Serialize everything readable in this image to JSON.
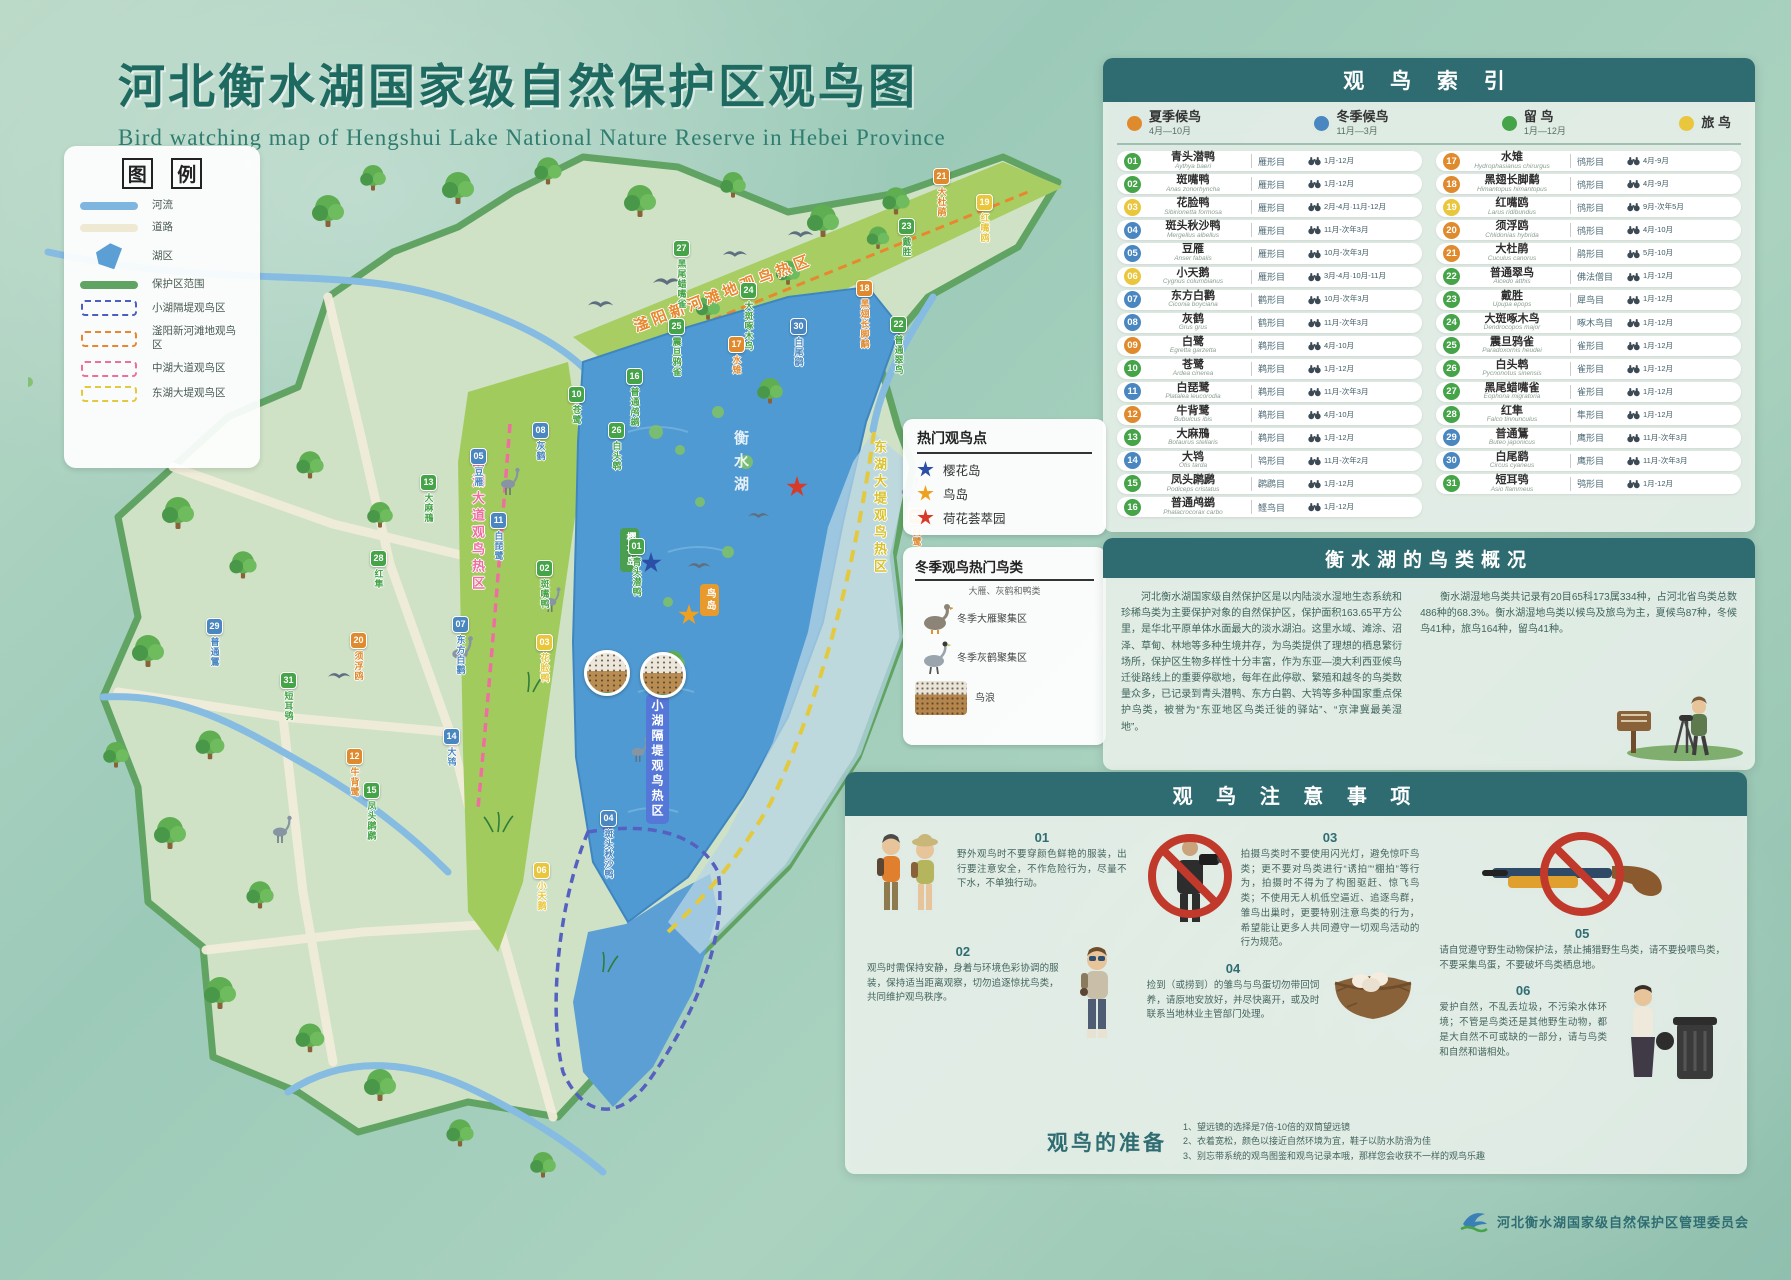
{
  "page": {
    "title": "河北衡水湖国家级自然保护区观鸟图",
    "subtitle": "Bird watching map of Hengshui Lake National Nature Reserve in Hebei Province"
  },
  "legend": {
    "title_left": "图",
    "title_right": "例",
    "items": [
      {
        "label": "河流",
        "type": "line",
        "color": "#7fb6df"
      },
      {
        "label": "道路",
        "type": "line",
        "color": "#efe8d2"
      },
      {
        "label": "湖区",
        "type": "poly",
        "color": "#5b9fd4"
      },
      {
        "label": "保护区范围",
        "type": "line",
        "color": "#61a363"
      },
      {
        "label": "小湖隔堤观鸟区",
        "type": "dash",
        "color": "#4a5fc0"
      },
      {
        "label": "滏阳新河滩地观鸟区",
        "type": "dash",
        "color": "#e8872e"
      },
      {
        "label": "中湖大道观鸟区",
        "type": "dash",
        "color": "#ee6f9f"
      },
      {
        "label": "东湖大堤观鸟区",
        "type": "dash",
        "color": "#e3c93d"
      }
    ]
  },
  "map": {
    "corridors": {
      "fuyang": "滏阳新河滩地观鸟热区",
      "zhonghu": "中湖大道观鸟热区",
      "donghu": "东湖大堤观鸟热区",
      "xiaohu": "小湖隔堤观鸟热区"
    },
    "lake_label": "衡水湖",
    "island_labels": [
      {
        "label": "樱花岛",
        "color": "#4a9e4f",
        "left": "592px",
        "top": "396px"
      },
      {
        "label": "鸟岛",
        "color": "#e99a2c",
        "left": "672px",
        "top": "452px"
      }
    ],
    "stars": [
      {
        "color": "#2b4fa7",
        "left": "612px",
        "top": "420px"
      },
      {
        "color": "#f0a01f",
        "left": "650px",
        "top": "472px"
      },
      {
        "color": "#d83a2a",
        "left": "758px",
        "top": "344px"
      }
    ],
    "photos": [
      {
        "label": "大雁",
        "left": "556px",
        "top": "518px"
      },
      {
        "label": "灰鹤",
        "left": "612px",
        "top": "520px"
      }
    ],
    "markers": [
      {
        "num": "21",
        "name": "大杜鹃",
        "color": "#e08a2e",
        "left": "905px",
        "top": "36px"
      },
      {
        "num": "19",
        "name": "红嘴鸥",
        "color": "#e9c63b",
        "left": "948px",
        "top": "62px"
      },
      {
        "num": "23",
        "name": "戴胜",
        "color": "#45a348",
        "left": "870px",
        "top": "86px"
      },
      {
        "num": "27",
        "name": "黑尾蜡嘴雀",
        "color": "#45a348",
        "left": "645px",
        "top": "108px"
      },
      {
        "num": "24",
        "name": "大斑啄木鸟",
        "color": "#45a348",
        "left": "712px",
        "top": "150px"
      },
      {
        "num": "18",
        "name": "黑翅长脚鹬",
        "color": "#e08a2e",
        "left": "828px",
        "top": "148px"
      },
      {
        "num": "22",
        "name": "普通翠鸟",
        "color": "#45a348",
        "left": "862px",
        "top": "184px"
      },
      {
        "num": "30",
        "name": "白尾鹞",
        "color": "#4a87c0",
        "left": "762px",
        "top": "186px"
      },
      {
        "num": "17",
        "name": "水雉",
        "color": "#e08a2e",
        "left": "700px",
        "top": "204px"
      },
      {
        "num": "25",
        "name": "震旦鸦雀",
        "color": "#45a348",
        "left": "640px",
        "top": "186px"
      },
      {
        "num": "16",
        "name": "普通鸬鹚",
        "color": "#45a348",
        "left": "598px",
        "top": "236px"
      },
      {
        "num": "10",
        "name": "苍鹭",
        "color": "#45a348",
        "left": "540px",
        "top": "254px"
      },
      {
        "num": "08",
        "name": "灰鹤",
        "color": "#4a87c0",
        "left": "504px",
        "top": "290px"
      },
      {
        "num": "05",
        "name": "豆雁",
        "color": "#4a87c0",
        "left": "442px",
        "top": "316px"
      },
      {
        "num": "13",
        "name": "大麻鳽",
        "color": "#45a348",
        "left": "392px",
        "top": "342px"
      },
      {
        "num": "26",
        "name": "白头鹎",
        "color": "#45a348",
        "left": "580px",
        "top": "290px"
      },
      {
        "num": "11",
        "name": "白琵鹭",
        "color": "#4a87c0",
        "left": "462px",
        "top": "380px"
      },
      {
        "num": "28",
        "name": "红隼",
        "color": "#45a348",
        "left": "342px",
        "top": "418px"
      },
      {
        "num": "02",
        "name": "斑嘴鸭",
        "color": "#45a348",
        "left": "508px",
        "top": "428px"
      },
      {
        "num": "01",
        "name": "青头潜鸭",
        "color": "#45a348",
        "left": "600px",
        "top": "406px"
      },
      {
        "num": "07",
        "name": "东方白鹳",
        "color": "#4a87c0",
        "left": "424px",
        "top": "484px"
      },
      {
        "num": "03",
        "name": "花脸鸭",
        "color": "#e9c63b",
        "left": "508px",
        "top": "502px"
      },
      {
        "num": "29",
        "name": "普通鵟",
        "color": "#4a87c0",
        "left": "178px",
        "top": "486px"
      },
      {
        "num": "31",
        "name": "短耳鸮",
        "color": "#45a348",
        "left": "252px",
        "top": "540px"
      },
      {
        "num": "20",
        "name": "须浮鸥",
        "color": "#e08a2e",
        "left": "322px",
        "top": "500px"
      },
      {
        "num": "14",
        "name": "大鸨",
        "color": "#4a87c0",
        "left": "415px",
        "top": "596px"
      },
      {
        "num": "12",
        "name": "牛背鹭",
        "color": "#e08a2e",
        "left": "318px",
        "top": "616px"
      },
      {
        "num": "15",
        "name": "凤头䴙䴘",
        "color": "#45a348",
        "left": "335px",
        "top": "650px"
      },
      {
        "num": "09",
        "name": "白鹭",
        "color": "#e08a2e",
        "left": "880px",
        "top": "376px"
      },
      {
        "num": "04",
        "name": "斑头秋沙鸭",
        "color": "#4a87c0",
        "left": "572px",
        "top": "678px"
      },
      {
        "num": "06",
        "name": "小天鹅",
        "color": "#e9c63b",
        "left": "505px",
        "top": "730px"
      }
    ]
  },
  "index": {
    "title": "观 鸟 索 引",
    "categories": [
      {
        "label": "夏季候鸟",
        "range": "4月—10月",
        "color": "#e08a2e"
      },
      {
        "label": "冬季候鸟",
        "range": "11月—3月",
        "color": "#4a87c0"
      },
      {
        "label": "留  鸟",
        "range": "1月—12月",
        "color": "#45a348"
      },
      {
        "label": "旅  鸟",
        "range": "",
        "color": "#e9c63b"
      }
    ],
    "birds": [
      {
        "num": "01",
        "name": "青头潜鸭",
        "latin": "Aythya baeri",
        "order": "雁形目",
        "months": "1月-12月",
        "color": "#45a348"
      },
      {
        "num": "02",
        "name": "斑嘴鸭",
        "latin": "Anas zonorhyncha",
        "order": "雁形目",
        "months": "1月-12月",
        "color": "#45a348"
      },
      {
        "num": "03",
        "name": "花脸鸭",
        "latin": "Sibirionetta formosa",
        "order": "雁形目",
        "months": "2月-4月·11月-12月",
        "color": "#e9c63b"
      },
      {
        "num": "04",
        "name": "斑头秋沙鸭",
        "latin": "Mergellus albellus",
        "order": "雁形目",
        "months": "11月-次年3月",
        "color": "#4a87c0"
      },
      {
        "num": "05",
        "name": "豆雁",
        "latin": "Anser fabalis",
        "order": "雁形目",
        "months": "10月-次年3月",
        "color": "#4a87c0"
      },
      {
        "num": "06",
        "name": "小天鹅",
        "latin": "Cygnus columbianus",
        "order": "雁形目",
        "months": "3月-4月·10月-11月",
        "color": "#e9c63b"
      },
      {
        "num": "07",
        "name": "东方白鹳",
        "latin": "Ciconia boyciana",
        "order": "鹳形目",
        "months": "10月-次年3月",
        "color": "#4a87c0"
      },
      {
        "num": "08",
        "name": "灰鹤",
        "latin": "Grus grus",
        "order": "鹤形目",
        "months": "11月-次年3月",
        "color": "#4a87c0"
      },
      {
        "num": "09",
        "name": "白鹭",
        "latin": "Egretta garzetta",
        "order": "鹈形目",
        "months": "4月-10月",
        "color": "#e08a2e"
      },
      {
        "num": "10",
        "name": "苍鹭",
        "latin": "Ardea cinerea",
        "order": "鹈形目",
        "months": "1月-12月",
        "color": "#45a348"
      },
      {
        "num": "11",
        "name": "白琵鹭",
        "latin": "Platalea leucorodia",
        "order": "鹈形目",
        "months": "11月-次年3月",
        "color": "#4a87c0"
      },
      {
        "num": "12",
        "name": "牛背鹭",
        "latin": "Bubulcus ibis",
        "order": "鹈形目",
        "months": "4月-10月",
        "color": "#e08a2e"
      },
      {
        "num": "13",
        "name": "大麻鳽",
        "latin": "Botaurus stellaris",
        "order": "鹈形目",
        "months": "1月-12月",
        "color": "#45a348"
      },
      {
        "num": "14",
        "name": "大鸨",
        "latin": "Otis tarda",
        "order": "鸨形目",
        "months": "11月-次年2月",
        "color": "#4a87c0"
      },
      {
        "num": "15",
        "name": "凤头䴙䴘",
        "latin": "Podiceps cristatus",
        "order": "䴙䴘目",
        "months": "1月-12月",
        "color": "#45a348"
      },
      {
        "num": "16",
        "name": "普通鸬鹚",
        "latin": "Phalacrocorax carbo",
        "order": "鲣鸟目",
        "months": "1月-12月",
        "color": "#45a348"
      },
      {
        "num": "17",
        "name": "水雉",
        "latin": "Hydrophasianus chirurgus",
        "order": "鸻形目",
        "months": "4月-9月",
        "color": "#e08a2e"
      },
      {
        "num": "18",
        "name": "黑翅长脚鹬",
        "latin": "Himantopus himantopus",
        "order": "鸻形目",
        "months": "4月-9月",
        "color": "#e08a2e"
      },
      {
        "num": "19",
        "name": "红嘴鸥",
        "latin": "Larus ridibundus",
        "order": "鸻形目",
        "months": "9月-次年5月",
        "color": "#e9c63b"
      },
      {
        "num": "20",
        "name": "须浮鸥",
        "latin": "Chlidonias hybrida",
        "order": "鸻形目",
        "months": "4月-10月",
        "color": "#e08a2e"
      },
      {
        "num": "21",
        "name": "大杜鹃",
        "latin": "Cuculus canorus",
        "order": "鹃形目",
        "months": "5月-10月",
        "color": "#e08a2e"
      },
      {
        "num": "22",
        "name": "普通翠鸟",
        "latin": "Alcedo atthis",
        "order": "佛法僧目",
        "months": "1月-12月",
        "color": "#45a348"
      },
      {
        "num": "23",
        "name": "戴胜",
        "latin": "Upupa epops",
        "order": "犀鸟目",
        "months": "1月-12月",
        "color": "#45a348"
      },
      {
        "num": "24",
        "name": "大斑啄木鸟",
        "latin": "Dendrocopos major",
        "order": "啄木鸟目",
        "months": "1月-12月",
        "color": "#45a348"
      },
      {
        "num": "25",
        "name": "震旦鸦雀",
        "latin": "Paradoxornis heudei",
        "order": "雀形目",
        "months": "1月-12月",
        "color": "#45a348"
      },
      {
        "num": "26",
        "name": "白头鹎",
        "latin": "Pycnonotus sinensis",
        "order": "雀形目",
        "months": "1月-12月",
        "color": "#45a348"
      },
      {
        "num": "27",
        "name": "黑尾蜡嘴雀",
        "latin": "Eophona migratoria",
        "order": "雀形目",
        "months": "1月-12月",
        "color": "#45a348"
      },
      {
        "num": "28",
        "name": "红隼",
        "latin": "Falco tinnunculus",
        "order": "隼形目",
        "months": "1月-12月",
        "color": "#45a348"
      },
      {
        "num": "29",
        "name": "普通鵟",
        "latin": "Buteo japonicus",
        "order": "鹰形目",
        "months": "11月-次年3月",
        "color": "#4a87c0"
      },
      {
        "num": "30",
        "name": "白尾鹞",
        "latin": "Circus cyaneus",
        "order": "鹰形目",
        "months": "11月-次年3月",
        "color": "#4a87c0"
      },
      {
        "num": "31",
        "name": "短耳鸮",
        "latin": "Asio flammeus",
        "order": "鸮形目",
        "months": "1月-12月",
        "color": "#45a348"
      }
    ]
  },
  "hotspots": {
    "title": "热门观鸟点",
    "items": [
      {
        "label": "樱花岛",
        "color": "#2b4fa7"
      },
      {
        "label": "鸟岛",
        "color": "#f0a01f"
      },
      {
        "label": "荷花荟萃园",
        "color": "#d83a2a"
      }
    ]
  },
  "winter": {
    "title": "冬季观鸟热门鸟类",
    "subtitle": "大雁、灰鹤和鸭类",
    "items": [
      {
        "label": "冬季大雁聚集区",
        "icon": "goose",
        "swatch": "#d0433b"
      },
      {
        "label": "冬季灰鹤聚集区",
        "icon": "crane",
        "swatch": "#e8c63a"
      },
      {
        "label": "鸟浪",
        "icon": "photo"
      }
    ]
  },
  "overview": {
    "title": "衡水湖的鸟类概况",
    "p1": "河北衡水湖国家级自然保护区是以内陆淡水湿地生态系统和珍稀鸟类为主要保护对象的自然保护区，保护面积163.65平方公里，是华北平原单体水面最大的淡水湖泊。这里水域、滩涂、沼泽、草甸、林地等多种生境并存，为鸟类提供了理想的栖息繁衍场所，保护区生物多样性十分丰富，作为东亚—澳大利西亚候鸟迁徙路线上的重要停歇地，每年在此停歇、繁殖和越冬的鸟类数量众多，已记录到青头潜鸭、东方白鹳、大鸨等多种国家重点保护鸟类，被誉为“东亚地区鸟类迁徙的驿站”、“京津冀最美湿地”。",
    "p2": "衡水湖湿地鸟类共记录有20目65科173属334种，占河北省鸟类总数486种的68.3%。衡水湖湿地鸟类以候鸟及旅鸟为主，夏候鸟87种，冬候鸟41种，旅鸟164种，留鸟41种。"
  },
  "notes": {
    "title": "观 鸟 注 意 事 项",
    "items": [
      {
        "num": "01",
        "text": "野外观鸟时不要穿颜色鲜艳的服装，出行要注意安全，不作危险行为，尽量不下水，不单独行动。"
      },
      {
        "num": "02",
        "text": "观鸟时需保持安静，身着与环境色彩协调的服装，保持适当距离观察，切勿追逐惊扰鸟类，共同维护观鸟秩序。"
      },
      {
        "num": "03",
        "text": "拍摄鸟类时不要使用闪光灯，避免惊吓鸟类；更不要对鸟类进行“诱拍”“棚拍”等行为，拍摄时不得为了构图驱赶、惊飞鸟类；不使用无人机低空逼近、追逐鸟群，雏鸟出巢时，更要特别注意鸟类的行为，希望能让更多人共同遵守一切观鸟活动的行为规范。"
      },
      {
        "num": "04",
        "text": "捡到（或捞到）的雏鸟与鸟蛋切勿带回饲养，请原地安放好，并尽快离开，或及时联系当地林业主管部门处理。"
      },
      {
        "num": "05",
        "text": "请自觉遵守野生动物保护法，禁止捕猎野生鸟类，请不要投喂鸟类，不要采集鸟蛋，不要破坏鸟类栖息地。"
      },
      {
        "num": "06",
        "text": "爱护自然，不乱丢垃圾，不污染水体环境；不管是鸟类还是其他野生动物，都是大自然不可或缺的一部分，请与鸟类和自然和谐相处。"
      }
    ]
  },
  "prep": {
    "title": "观鸟的准备",
    "lines": [
      "1、望远镜的选择是7倍-10倍的双筒望远镜",
      "2、衣着宽松，颜色以接近自然环境为宜，鞋子以防水防滑为佳",
      "3、别忘带系统的观鸟图鉴和观鸟记录本哦，那样您会收获不一样的观鸟乐趣"
    ]
  },
  "footer": {
    "org": "河北衡水湖国家级自然保护区管理委员会"
  }
}
